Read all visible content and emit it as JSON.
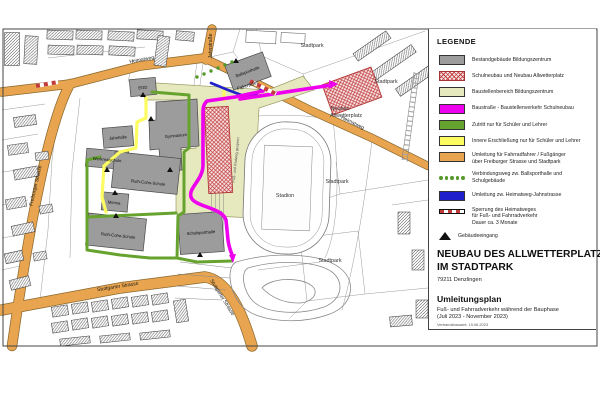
{
  "legend": {
    "title": "LEGENDE",
    "items": [
      {
        "label": "Bestandgebäude Bildungszentrum",
        "swatch": "solid",
        "color": "#9C9C9C"
      },
      {
        "label": "Schulneubau und Neubau Allwetterplatz",
        "swatch": "crosshatch",
        "color": "#C23B3B"
      },
      {
        "label": "Baustellenbereich Bildungszentrum",
        "swatch": "solid",
        "color": "#E6E8BE"
      },
      {
        "label": "Baustraße - Baustellenverkehr Schulneubau",
        "swatch": "solid",
        "color": "#EE00EE"
      },
      {
        "label": "Zutritt nur für Schüler und Lehrer",
        "swatch": "solid",
        "color": "#66A32E"
      },
      {
        "label": "Innere Erschließung nur für Schüler und Lehrer",
        "swatch": "solid",
        "color": "#FCFC60"
      },
      {
        "label": "Umleitung für Fahrradfahrer / Fußgänger\nüber Freiburger Strasse und Stadtpark",
        "swatch": "solid",
        "color": "#E8A44E"
      },
      {
        "label": "Verbindungsweg zw. Ballsporthalle und Schulgebäude",
        "swatch": "dots",
        "color": "#55992B"
      },
      {
        "label": "Umleitung zw. Heimatweg-Jahnstrasse",
        "swatch": "solid",
        "color": "#1F1FCC"
      },
      {
        "label": "Sperrung des Heimatweges\nfür Fuß- und Fahrradverkehr\nDauer ca. 3 Monate",
        "swatch": "barrier",
        "color": "#C23B3B"
      },
      {
        "label": "Gebäudeeingang",
        "swatch": "triangle",
        "color": "#111111"
      }
    ]
  },
  "title_block": {
    "line1": "NEUBAU DES ALLWETTERPLATZES",
    "line2": "IM STADTPARK",
    "address": "79211 Denzlingen",
    "subtitle": "Umleitungsplan",
    "description": "Fuß- und Fahrradverkehr während der Bauphase",
    "period": "(Juli 2023 - November 2023)",
    "issuer": "Verbandsbauamt, 19.06.2023"
  },
  "map": {
    "street_labels": [
      {
        "name": "label-jahnstrasse",
        "text": "Jahnstraße",
        "x": 212,
        "y": 46,
        "r": -90
      },
      {
        "name": "label-heimatweg-west",
        "text": "Heimatweg",
        "x": 142,
        "y": 61,
        "r": -10
      },
      {
        "name": "label-heimatweg-east",
        "text": "Heimatweg",
        "x": 352,
        "y": 124,
        "r": 26
      },
      {
        "name": "label-freiburger-strasse",
        "text": "Freiburger Strasse",
        "x": 37,
        "y": 186,
        "r": -77
      },
      {
        "name": "label-stuttgarter-strasse-1",
        "text": "Stuttgarter Strasse",
        "x": 118,
        "y": 288,
        "r": -9
      },
      {
        "name": "label-stuttgarter-strasse-2",
        "text": "Stuttgarter Strasse",
        "x": 221,
        "y": 298,
        "r": 58
      },
      {
        "name": "label-fahrraeder",
        "text": "Fahrräder",
        "x": 248,
        "y": 87,
        "r": -18
      }
    ],
    "area_labels": [
      {
        "name": "label-stadtpark-1",
        "text": "Stadtpark",
        "x": 312,
        "y": 47,
        "r": 0
      },
      {
        "name": "label-stadtpark-2",
        "text": "Stadtpark",
        "x": 386,
        "y": 83,
        "r": 0
      },
      {
        "name": "label-stadtpark-3",
        "text": "Stadtpark",
        "x": 337,
        "y": 183,
        "r": 0
      },
      {
        "name": "label-stadtpark-4",
        "text": "Stadtpark",
        "x": 330,
        "y": 262,
        "r": 0
      },
      {
        "name": "label-stadion",
        "text": "Stadion",
        "x": 285,
        "y": 197,
        "r": 0
      },
      {
        "name": "label-neubau-allwetterplatz-1",
        "text": "Neubau",
        "x": 340,
        "y": 110,
        "r": 0
      },
      {
        "name": "label-neubau-allwetterplatz-2",
        "text": "Allwetterplatz",
        "x": 346,
        "y": 117,
        "r": 0
      }
    ],
    "building_labels": [
      {
        "name": "label-egd",
        "text": "EGD",
        "x": 143,
        "y": 89,
        "r": -5
      },
      {
        "name": "label-ballsporthalle",
        "text": "Ballsporthalle",
        "x": 248,
        "y": 73,
        "r": -21
      },
      {
        "name": "label-gymnasium",
        "text": "Gymnasium",
        "x": 176,
        "y": 137,
        "r": -6
      },
      {
        "name": "label-jahnhalle",
        "text": "Jahnhalle",
        "x": 118,
        "y": 139,
        "r": -5
      },
      {
        "name": "label-werkrealschule",
        "text": "Werkrealschule",
        "x": 107,
        "y": 161,
        "r": 5
      },
      {
        "name": "label-mensa",
        "text": "Mensa",
        "x": 114,
        "y": 204,
        "r": 5
      },
      {
        "name": "label-ruth-cohn-schule-1",
        "text": "Ruth-Cohn-Schule",
        "x": 148,
        "y": 184,
        "r": 6
      },
      {
        "name": "label-ruth-cohn-schule-2",
        "text": "Ruth-Cohn-Schule",
        "x": 118,
        "y": 237,
        "r": 6
      },
      {
        "name": "label-schulsporthalle",
        "text": "Schulsporthalle",
        "x": 201,
        "y": 234,
        "r": -4
      }
    ],
    "note_labels": [
      {
        "name": "label-radweg-gesperrt",
        "text": "Fuß- und Radweg gesperrt",
        "x": 237,
        "y": 160,
        "r": -84
      }
    ]
  }
}
